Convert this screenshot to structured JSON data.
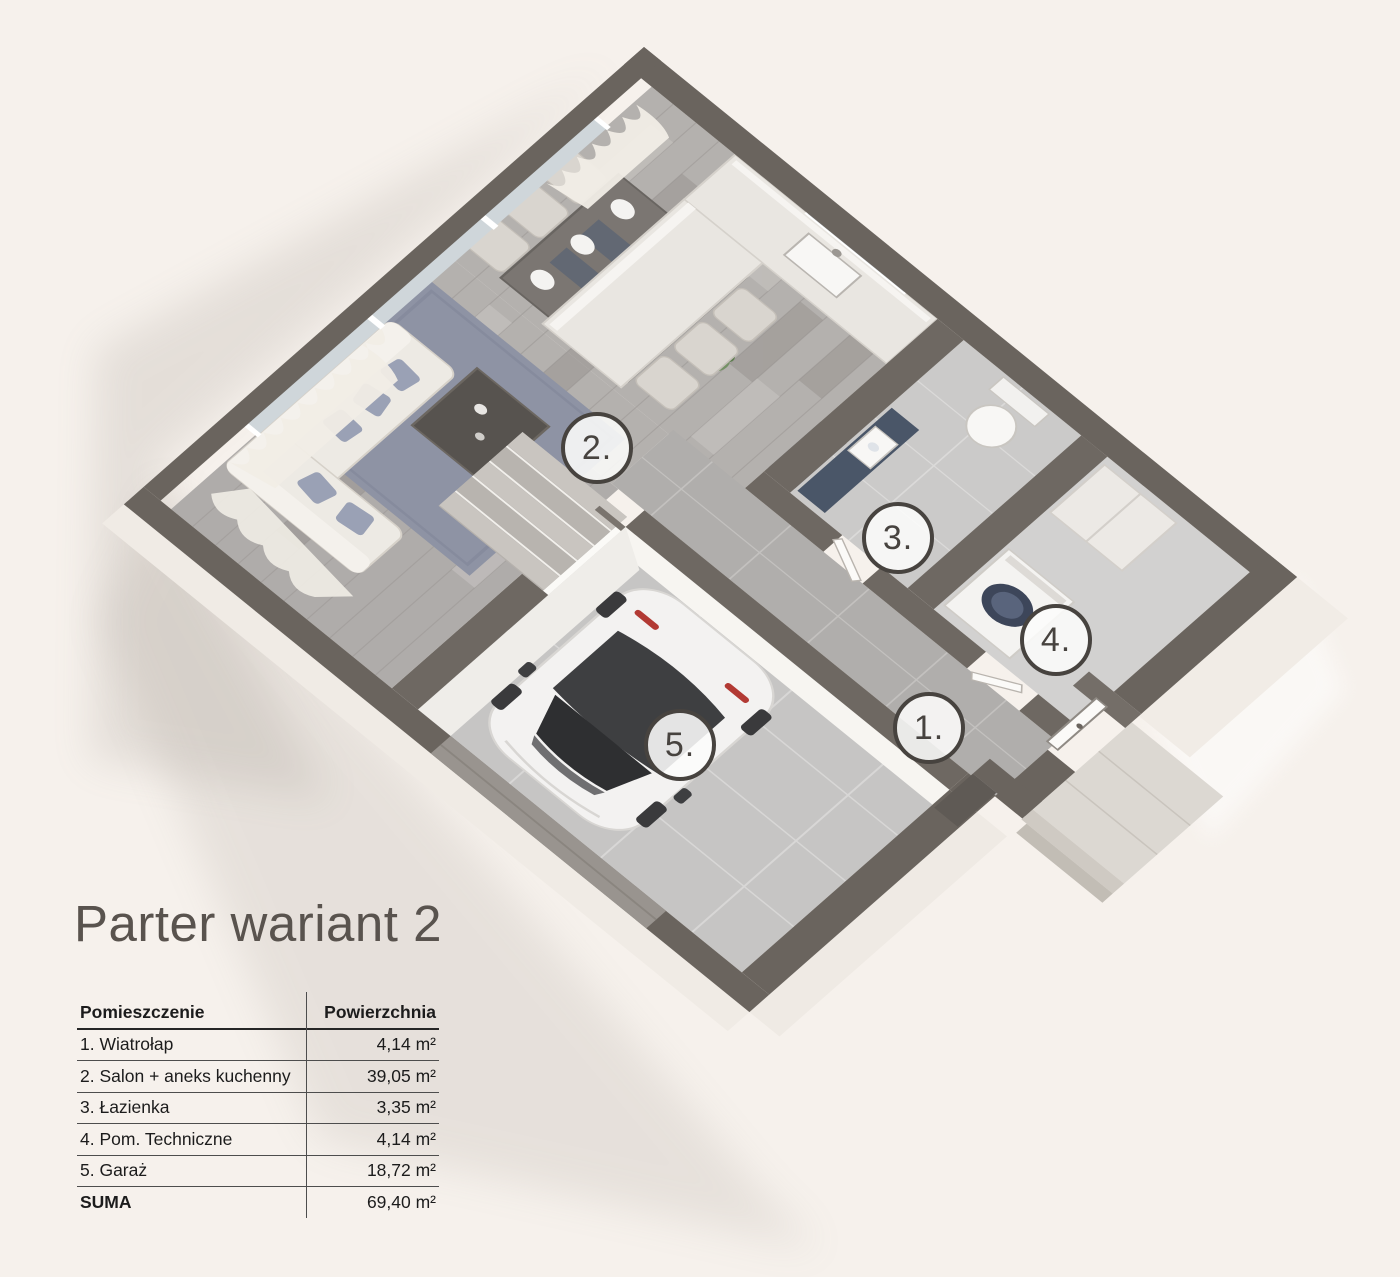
{
  "title": "Parter wariant 2",
  "floorplan": {
    "badges": [
      {
        "label": "1."
      },
      {
        "label": "2."
      },
      {
        "label": "3."
      },
      {
        "label": "4."
      },
      {
        "label": "5."
      }
    ]
  },
  "table": {
    "headers": {
      "room": "Pomieszczenie",
      "area": "Powierzchnia"
    },
    "rows": [
      {
        "room": "1. Wiatrołap",
        "area": "4,14 m²"
      },
      {
        "room": "2. Salon + aneks kuchenny",
        "area": "39,05 m²"
      },
      {
        "room": "3. Łazienka",
        "area": "3,35 m²"
      },
      {
        "room": "4. Pom. Techniczne",
        "area": "4,14 m²"
      },
      {
        "room": "5. Garaż",
        "area": "18,72 m²"
      }
    ],
    "total": {
      "room": "SUMA",
      "area": "69,40 m²"
    }
  },
  "colors": {
    "background": "#f6f1ec",
    "wall_cap": "#6a645e",
    "accent_navy": "#4a5668",
    "rug_blue": "#8e93a4",
    "badge_outline": "#47433f"
  }
}
